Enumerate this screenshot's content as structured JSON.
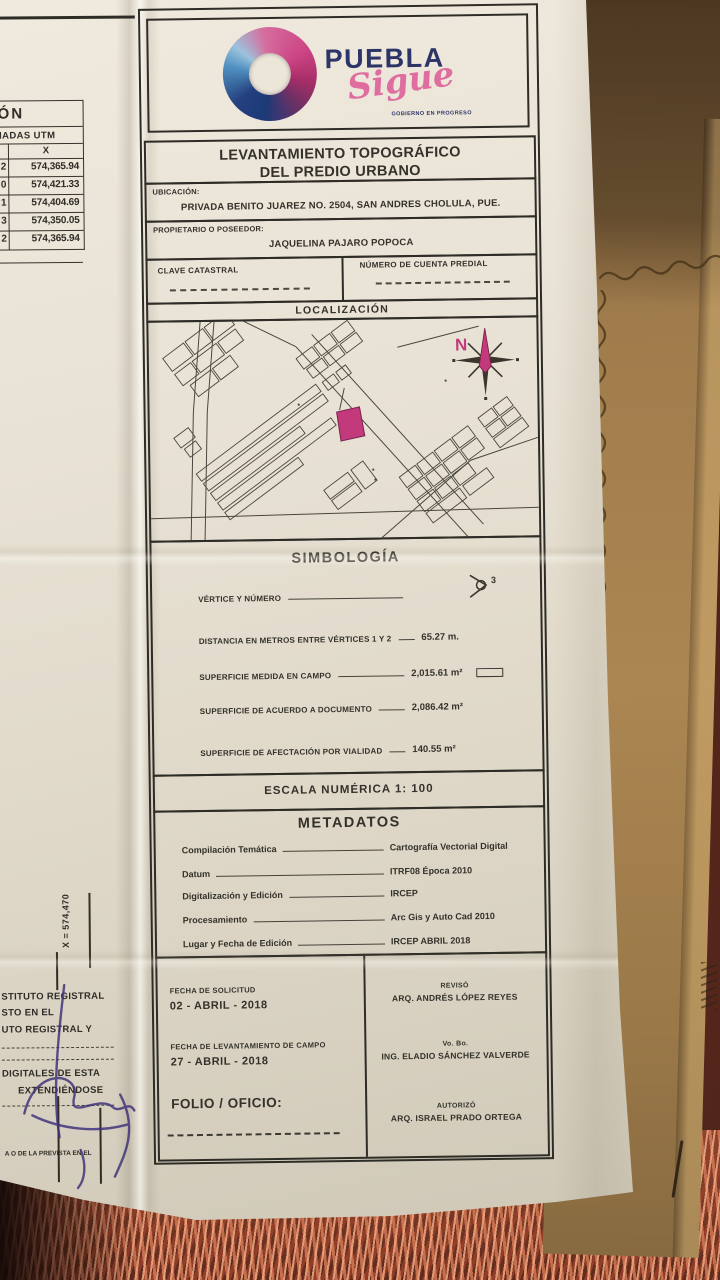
{
  "document": {
    "logo": {
      "brand": "PUEBLA",
      "script": "Sigue",
      "tagline": "GOBIERNO EN PROGRESO"
    },
    "title_line1": "LEVANTAMIENTO TOPOGRÁFICO",
    "title_line2": "DEL PREDIO URBANO",
    "ubicacion_label": "UBICACIÓN:",
    "ubicacion_value": "PRIVADA BENITO JUAREZ NO. 2504, SAN ANDRES CHOLULA, PUE.",
    "propietario_label": "PROPIETARIO O POSEEDOR:",
    "propietario_value": "JAQUELINA PAJARO POPOCA",
    "clave_catastral_label": "CLAVE CATASTRAL",
    "cuenta_predial_label": "NÚMERO DE CUENTA PREDIAL",
    "localizacion_title": "LOCALIZACIÓN",
    "north_label": "N",
    "simbologia": {
      "title": "SIMBOLOGÍA",
      "vertex_number": "3",
      "rows": [
        {
          "label": "VÉRTICE Y NÚMERO",
          "value": ""
        },
        {
          "label": "DISTANCIA EN METROS ENTRE VÉRTICES 1 Y 2",
          "value": "65.27 m."
        },
        {
          "label": "SUPERFICIE MEDIDA EN CAMPO",
          "value": "2,015.61 m²"
        },
        {
          "label": "SUPERFICIE DE ACUERDO A DOCUMENTO",
          "value": "2,086.42 m²"
        },
        {
          "label": "SUPERFICIE DE AFECTACIÓN POR VIALIDAD",
          "value": "140.55 m²"
        }
      ]
    },
    "escala": "ESCALA NUMÉRICA 1: 100",
    "metadatos": {
      "title": "METADATOS",
      "rows": [
        {
          "label": "Compilación Temática",
          "value": "Cartografía Vectorial Digital"
        },
        {
          "label": "Datum",
          "value": "ITRF08 Época 2010"
        },
        {
          "label": "Digitalización y Edición",
          "value": "IRCEP"
        },
        {
          "label": "Procesamiento",
          "value": "Arc Gis y Auto Cad 2010"
        },
        {
          "label": "Lugar y Fecha de Edición",
          "value": "IRCEP ABRIL 2018"
        }
      ]
    },
    "footer": {
      "fecha_solicitud_label": "FECHA DE SOLICITUD",
      "fecha_solicitud_value": "02 - ABRIL - 2018",
      "fecha_levantamiento_label": "FECHA DE LEVANTAMIENTO DE CAMPO",
      "fecha_levantamiento_value": "27 - ABRIL - 2018",
      "folio_label": "FOLIO / OFICIO:",
      "reviso_role": "REVISÓ",
      "reviso_name": "ARQ. ANDRÉS LÓPEZ REYES",
      "vobo_role": "Vo. Bo.",
      "vobo_name": "ING. ELADIO SÁNCHEZ VALVERDE",
      "autorizo_role": "AUTORIZÓ",
      "autorizo_name": "ARQ. ISRAEL PRADO ORTEGA"
    }
  },
  "left_panel": {
    "table": {
      "header_partial": "ÓN",
      "subheader_partial": "NADAS UTM",
      "col_x": "X",
      "rows": [
        {
          "n": "2",
          "x": "574,365.94"
        },
        {
          "n": "0",
          "x": "574,421.33"
        },
        {
          "n": "1",
          "x": "574,404.69"
        },
        {
          "n": "3",
          "x": "574,350.05"
        },
        {
          "n": "2",
          "x": "574,365.94"
        }
      ]
    },
    "grid_label": "X = 574,470",
    "legal_lines": [
      "STITUTO REGISTRAL",
      "STO EN EL",
      "UTO REGISTRAL Y",
      "DIGITALES DE ESTA",
      "EXTENDIÉNDOSE"
    ],
    "legal_footnote": "A O DE LA PREVISTA EN EL"
  },
  "colors": {
    "accent_pink": "#c23a7c",
    "logo_navy": "#2d3467",
    "logo_pink": "#df6da0",
    "paper": "#e7e1d4",
    "envelope": "#a5814e",
    "carpet": "#7c3a27"
  }
}
